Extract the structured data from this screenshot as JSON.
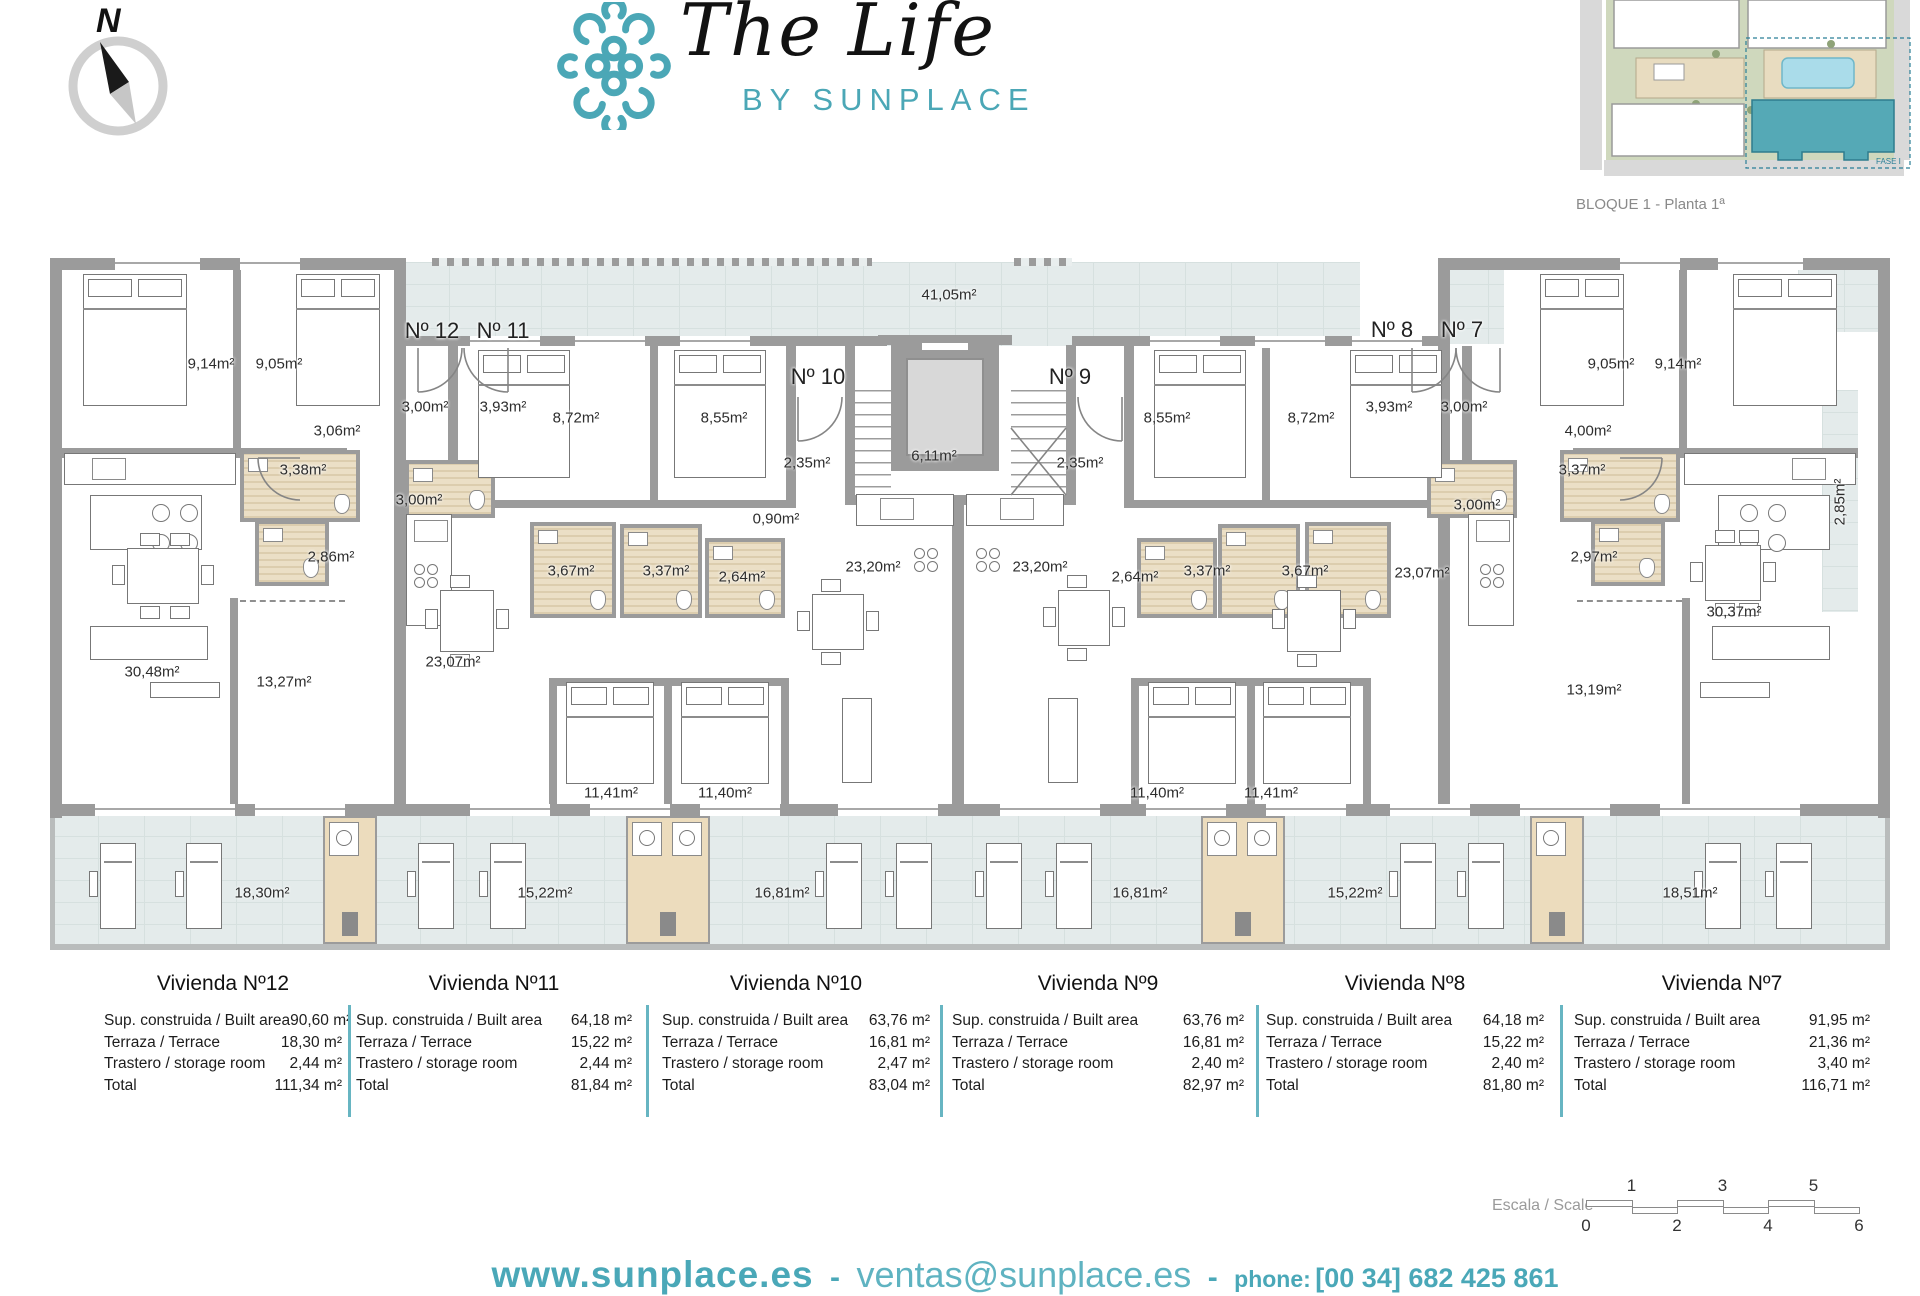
{
  "accent": "#4BA7B6",
  "header": {
    "compass_letter": "N",
    "logo_title": "The Life",
    "logo_subtitle": "BY SUNPLACE"
  },
  "siteplan": {
    "caption": "BLOQUE 1 - Planta 1ª",
    "fase_label": "FASE I"
  },
  "plan": {
    "apartment_labels": [
      {
        "text": "Nº 12",
        "x": 432,
        "y": 331
      },
      {
        "text": "Nº 11",
        "x": 503,
        "y": 331
      },
      {
        "text": "Nº 10",
        "x": 818,
        "y": 377
      },
      {
        "text": "Nº 9",
        "x": 1070,
        "y": 377
      },
      {
        "text": "Nº 8",
        "x": 1392,
        "y": 330
      },
      {
        "text": "Nº 7",
        "x": 1462,
        "y": 330
      }
    ],
    "room_labels": [
      {
        "text": "41,05m²",
        "x": 949,
        "y": 295
      },
      {
        "text": "9,14m²",
        "x": 211,
        "y": 364
      },
      {
        "text": "9,05m²",
        "x": 279,
        "y": 364
      },
      {
        "text": "3,06m²",
        "x": 337,
        "y": 431
      },
      {
        "text": "3,00m²",
        "x": 425,
        "y": 407
      },
      {
        "text": "3,93m²",
        "x": 503,
        "y": 407
      },
      {
        "text": "3,38m²",
        "x": 303,
        "y": 470
      },
      {
        "text": "3,00m²",
        "x": 419,
        "y": 500
      },
      {
        "text": "2,86m²",
        "x": 331,
        "y": 557
      },
      {
        "text": "30,48m²",
        "x": 152,
        "y": 672
      },
      {
        "text": "13,27m²",
        "x": 284,
        "y": 682
      },
      {
        "text": "8,72m²",
        "x": 576,
        "y": 418
      },
      {
        "text": "8,55m²",
        "x": 724,
        "y": 418
      },
      {
        "text": "3,67m²",
        "x": 571,
        "y": 571
      },
      {
        "text": "3,37m²",
        "x": 666,
        "y": 571
      },
      {
        "text": "2,64m²",
        "x": 742,
        "y": 577
      },
      {
        "text": "23,07m²",
        "x": 453,
        "y": 662
      },
      {
        "text": "11,41m²",
        "x": 611,
        "y": 793
      },
      {
        "text": "11,40m²",
        "x": 725,
        "y": 793
      },
      {
        "text": "2,35m²",
        "x": 807,
        "y": 463
      },
      {
        "text": "0,90m²",
        "x": 776,
        "y": 519
      },
      {
        "text": "6,11m²",
        "x": 934,
        "y": 456
      },
      {
        "text": "23,20m²",
        "x": 873,
        "y": 567
      },
      {
        "text": "2,35m²",
        "x": 1080,
        "y": 463
      },
      {
        "text": "23,20m²",
        "x": 1040,
        "y": 567
      },
      {
        "text": "8,55m²",
        "x": 1167,
        "y": 418
      },
      {
        "text": "8,72m²",
        "x": 1311,
        "y": 418
      },
      {
        "text": "2,64m²",
        "x": 1135,
        "y": 577
      },
      {
        "text": "3,37m²",
        "x": 1207,
        "y": 571
      },
      {
        "text": "3,67m²",
        "x": 1305,
        "y": 571
      },
      {
        "text": "23,07m²",
        "x": 1422,
        "y": 573
      },
      {
        "text": "11,40m²",
        "x": 1157,
        "y": 793
      },
      {
        "text": "11,41m²",
        "x": 1271,
        "y": 793
      },
      {
        "text": "3,93m²",
        "x": 1389,
        "y": 407
      },
      {
        "text": "3,00m²",
        "x": 1464,
        "y": 407
      },
      {
        "text": "3,00m²",
        "x": 1477,
        "y": 505
      },
      {
        "text": "9,05m²",
        "x": 1611,
        "y": 364
      },
      {
        "text": "9,14m²",
        "x": 1678,
        "y": 364
      },
      {
        "text": "4,00m²",
        "x": 1588,
        "y": 431
      },
      {
        "text": "3,37m²",
        "x": 1582,
        "y": 470
      },
      {
        "text": "2,97m²",
        "x": 1594,
        "y": 557
      },
      {
        "text": "30,37m²",
        "x": 1734,
        "y": 612
      },
      {
        "text": "13,19m²",
        "x": 1594,
        "y": 690
      },
      {
        "text": "2,85m²",
        "x": 1840,
        "y": 502,
        "vertical": true
      },
      {
        "text": "18,30m²",
        "x": 262,
        "y": 893
      },
      {
        "text": "15,22m²",
        "x": 545,
        "y": 893
      },
      {
        "text": "16,81m²",
        "x": 782,
        "y": 893
      },
      {
        "text": "16,81m²",
        "x": 1140,
        "y": 893
      },
      {
        "text": "15,22m²",
        "x": 1355,
        "y": 893
      },
      {
        "text": "18,51m²",
        "x": 1690,
        "y": 893
      }
    ]
  },
  "tables": {
    "row_labels": [
      "Sup. construida / Built area",
      "Terraza / Terrace",
      "Trastero / storage room",
      "Total"
    ],
    "columns": [
      {
        "title": "Vivienda Nº12",
        "x": 104,
        "w": 238,
        "values": [
          "90,60 m²",
          "18,30 m²",
          "2,44 m²",
          "111,34 m²"
        ]
      },
      {
        "title": "Vivienda Nº11",
        "x": 356,
        "w": 276,
        "values": [
          "64,18 m²",
          "15,22 m²",
          "2,44 m²",
          "81,84 m²"
        ]
      },
      {
        "title": "Vivienda Nº10",
        "x": 662,
        "w": 268,
        "values": [
          "63,76 m²",
          "16,81 m²",
          "2,47 m²",
          "83,04 m²"
        ]
      },
      {
        "title": "Vivienda Nº9",
        "x": 952,
        "w": 292,
        "values": [
          "63,76 m²",
          "16,81 m²",
          "2,40 m²",
          "82,97 m²"
        ]
      },
      {
        "title": "Vivienda Nº8",
        "x": 1266,
        "w": 278,
        "values": [
          "64,18 m²",
          "15,22 m²",
          "2,40 m²",
          "81,80 m²"
        ]
      },
      {
        "title": "Vivienda Nº7",
        "x": 1574,
        "w": 296,
        "values": [
          "91,95 m²",
          "21,36 m²",
          "3,40 m²",
          "116,71 m²"
        ]
      }
    ],
    "divider_x": [
      348,
      646,
      940,
      1256,
      1560
    ]
  },
  "scalebar": {
    "label": "Escala / Scale",
    "top_numbers": [
      "1",
      "3",
      "5"
    ],
    "bottom_numbers": [
      "0",
      "2",
      "4",
      "6"
    ]
  },
  "footer": {
    "website": "www.sunplace.es",
    "separator": "-",
    "email": "ventas@sunplace.es",
    "phone_label": "phone:",
    "phone": "[00 34] 682 425 861"
  }
}
